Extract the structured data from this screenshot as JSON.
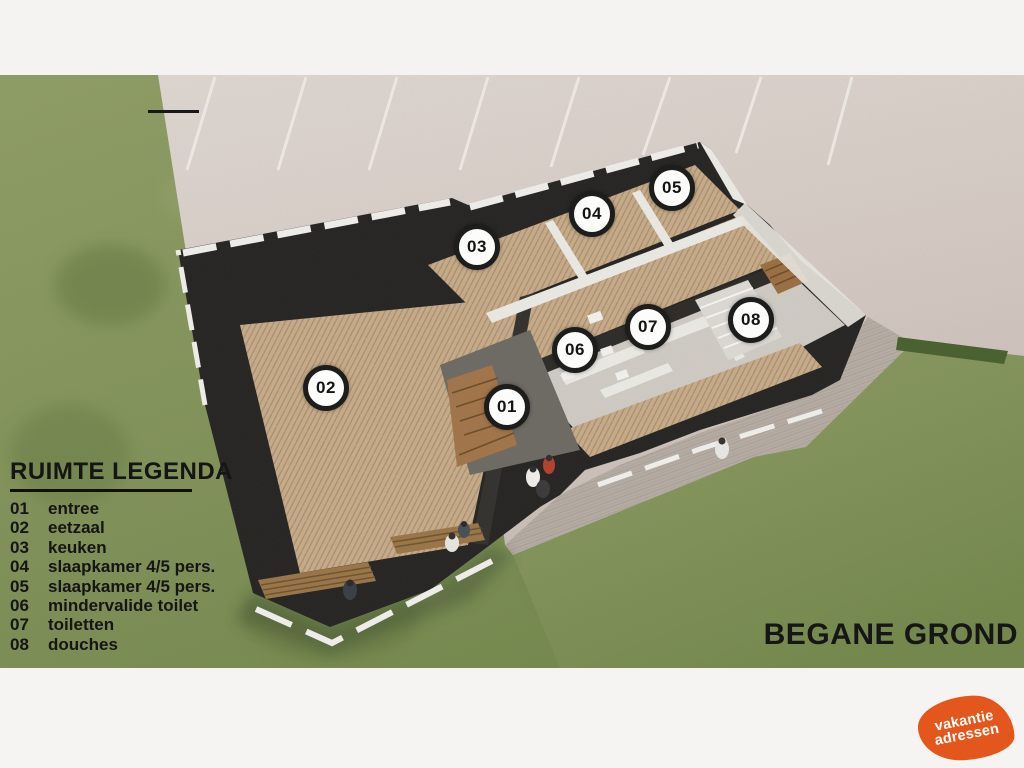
{
  "scene": {
    "floor_title": "BEGANE GROND",
    "type_label": "floor-plan-rendering"
  },
  "legend": {
    "title": "RUIMTE LEGENDA",
    "items": [
      {
        "num": "01",
        "label": "entree"
      },
      {
        "num": "02",
        "label": "eetzaal"
      },
      {
        "num": "03",
        "label": "keuken"
      },
      {
        "num": "04",
        "label": "slaapkamer 4/5 pers."
      },
      {
        "num": "05",
        "label": "slaapkamer 4/5 pers."
      },
      {
        "num": "06",
        "label": "mindervalide toilet"
      },
      {
        "num": "07",
        "label": "toiletten"
      },
      {
        "num": "08",
        "label": "douches"
      }
    ]
  },
  "rooms": [
    {
      "num": "01"
    },
    {
      "num": "02"
    },
    {
      "num": "03"
    },
    {
      "num": "04"
    },
    {
      "num": "05"
    },
    {
      "num": "06"
    },
    {
      "num": "07"
    },
    {
      "num": "08"
    }
  ],
  "logo": {
    "line1": "vakantie",
    "line2": "adressen",
    "color": "#e4571c"
  },
  "colors": {
    "grass": "#83945a",
    "pavement": "#d6cec8",
    "plaza": "#b3aaa2",
    "wood_floor": "#c7ab8a",
    "wall_dark": "#262523",
    "wall_cap": "#f0eeea",
    "text": "#161616",
    "frame": "#f4f3f1"
  }
}
